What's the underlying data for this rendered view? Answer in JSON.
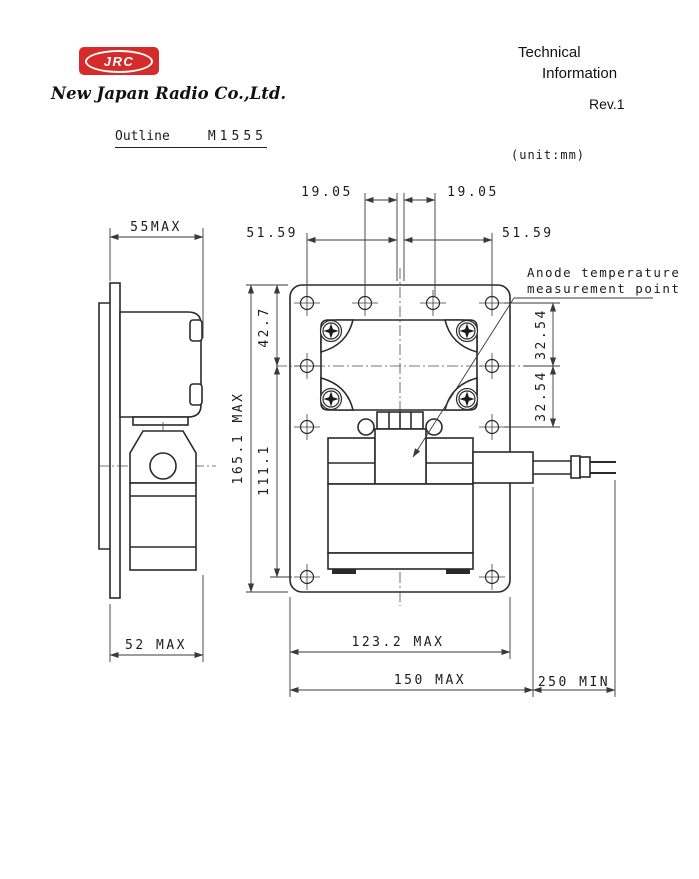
{
  "header": {
    "logo": "JRC",
    "company": "New Japan Radio Co.,Ltd.",
    "doc_line1": "Technical",
    "doc_line2": "Information",
    "revision": "Rev.1"
  },
  "title": {
    "label": "Outline",
    "model": "M1555",
    "unit": "(unit:mm)"
  },
  "annotation": {
    "line1": "Anode temperature",
    "line2": "measurement point"
  },
  "dims": {
    "pitch_left": "19.05",
    "pitch_right": "19.05",
    "offset_left": "51.59",
    "offset_right": "51.59",
    "depth_max": "55MAX",
    "height_max": "165.1 MAX",
    "top_to_center": "42.7",
    "center_to_bottom": "111.1",
    "hole_pitch_upper": "32.54",
    "hole_pitch_lower": "32.54",
    "side_depth_max": "52 MAX",
    "flange_width": "123.2 MAX",
    "overall_width": "150 MAX",
    "lead_min": "250 MIN"
  },
  "colors": {
    "brand_red": "#d62b2b",
    "ink": "#1c1c1c",
    "paper": "#ffffff"
  }
}
